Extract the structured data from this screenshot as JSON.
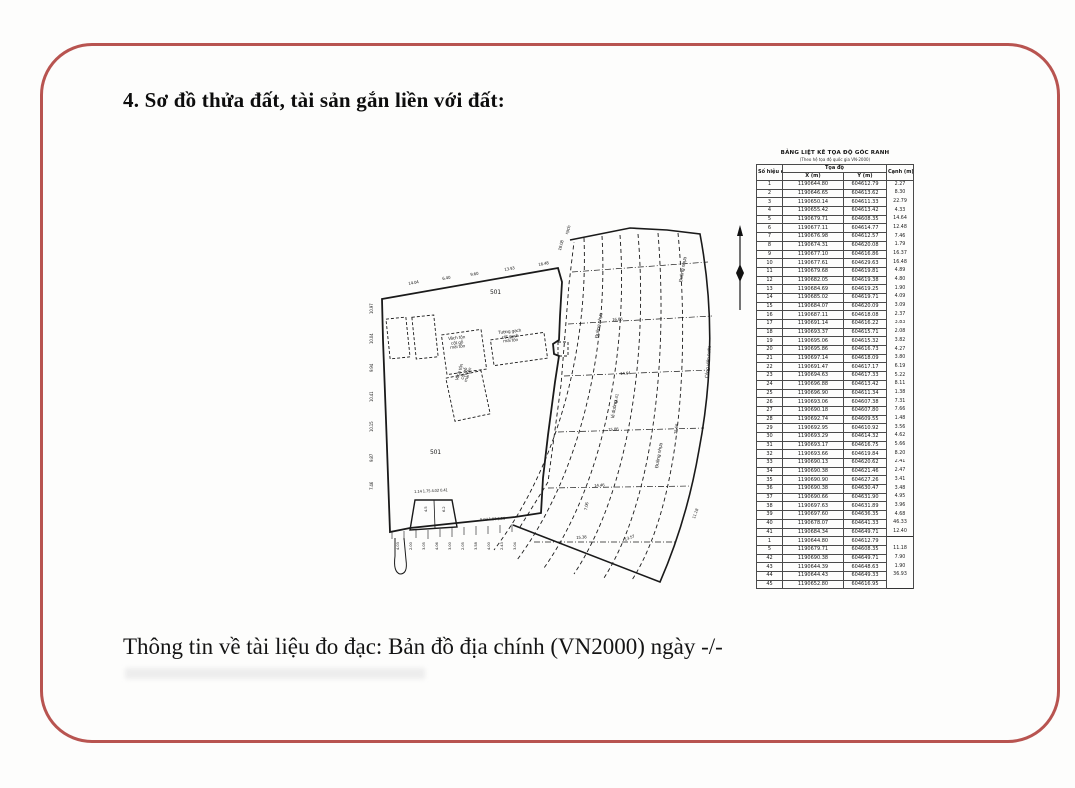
{
  "page": {
    "title": "4. Sơ đồ thửa đất, tài sản gắn liền với đất:",
    "footer_text": "Thông tin về tài liệu đo đạc: Bản đồ địa chính (VN2000) ngày -/-",
    "border_color": "#b85450"
  },
  "map": {
    "labels": [
      {
        "t": "501",
        "x": 128,
        "y": 70,
        "r": 0,
        "fs": 6
      },
      {
        "t": "501",
        "x": 68,
        "y": 230,
        "r": 0,
        "fs": 6
      },
      {
        "t": "Vách tôn\ncột gỗ\nmái tôn",
        "x": 86,
        "y": 118,
        "r": -6,
        "fs": 4.3,
        "c": 1
      },
      {
        "t": "Tường gạch\ncột gạch\nmái tôn",
        "x": 136,
        "y": 112,
        "r": -6,
        "fs": 4.3,
        "c": 1
      },
      {
        "t": "Vách tôn\ncột gỗ\nmái tôn",
        "x": 94,
        "y": 160,
        "r": -72,
        "fs": 4.3,
        "c": 1
      },
      {
        "t": "rạch",
        "x": 204,
        "y": 14,
        "r": -72,
        "fs": 4.5
      },
      {
        "t": "Đường nhựa",
        "x": 234,
        "y": 118,
        "r": -80,
        "fs": 4.5
      },
      {
        "t": "lề đường",
        "x": 250,
        "y": 198,
        "r": -80,
        "fs": 4.5
      },
      {
        "t": "Đường nhựa",
        "x": 294,
        "y": 248,
        "r": -80,
        "fs": 4.5
      },
      {
        "t": "Đường nhựa",
        "x": 318,
        "y": 62,
        "r": -80,
        "fs": 4.5
      },
      {
        "t": "Công viên nước",
        "x": 344,
        "y": 158,
        "r": -85,
        "fs": 4.5
      },
      {
        "t": "14.04",
        "x": 46,
        "y": 62,
        "r": -10,
        "fs": 4
      },
      {
        "t": "6.40",
        "x": 80,
        "y": 57,
        "r": -10,
        "fs": 4
      },
      {
        "t": "9.60",
        "x": 108,
        "y": 53,
        "r": -10,
        "fs": 4
      },
      {
        "t": "13.93",
        "x": 142,
        "y": 48,
        "r": -10,
        "fs": 4
      },
      {
        "t": "16.48",
        "x": 176,
        "y": 43,
        "r": -10,
        "fs": 4
      },
      {
        "t": "18.08",
        "x": 196,
        "y": 30,
        "r": -75,
        "fs": 4
      },
      {
        "t": "10.97",
        "x": 8,
        "y": 94,
        "r": -90,
        "fs": 4
      },
      {
        "t": "10.04",
        "x": 8,
        "y": 124,
        "r": -90,
        "fs": 4
      },
      {
        "t": "9.94",
        "x": 8,
        "y": 152,
        "r": -90,
        "fs": 4
      },
      {
        "t": "10.41",
        "x": 8,
        "y": 182,
        "r": -90,
        "fs": 4
      },
      {
        "t": "10.15",
        "x": 8,
        "y": 212,
        "r": -90,
        "fs": 4
      },
      {
        "t": "9.87",
        "x": 8,
        "y": 242,
        "r": -90,
        "fs": 4
      },
      {
        "t": "7.46",
        "x": 8,
        "y": 270,
        "r": -90,
        "fs": 4
      },
      {
        "t": "44.41",
        "x": 252,
        "y": 184,
        "r": -82,
        "fs": 4
      },
      {
        "t": "75.66",
        "x": 312,
        "y": 214,
        "r": -84,
        "fs": 4
      },
      {
        "t": "7.06",
        "x": 222,
        "y": 290,
        "r": -80,
        "fs": 4
      },
      {
        "t": "13.57",
        "x": 262,
        "y": 318,
        "r": -20,
        "fs": 4
      },
      {
        "t": "11.18",
        "x": 330,
        "y": 298,
        "r": -70,
        "fs": 4
      },
      {
        "t": "16.86",
        "x": 250,
        "y": 98,
        "r": -4,
        "fs": 4
      },
      {
        "t": "14.64",
        "x": 258,
        "y": 152,
        "r": -4,
        "fs": 4
      },
      {
        "t": "15.86",
        "x": 246,
        "y": 208,
        "r": -4,
        "fs": 4
      },
      {
        "t": "14.46",
        "x": 232,
        "y": 264,
        "r": -4,
        "fs": 4
      },
      {
        "t": "15.38",
        "x": 214,
        "y": 316,
        "r": -4,
        "fs": 4
      },
      {
        "t": "1.14 1.75 4.02 0.41",
        "x": 52,
        "y": 270,
        "r": -3,
        "fs": 3.8
      },
      {
        "t": "5.07 1.97 5.96",
        "x": 118,
        "y": 298,
        "r": -3,
        "fs": 3.8
      },
      {
        "t": "4.5",
        "x": 62,
        "y": 292,
        "r": -90,
        "fs": 3.8
      },
      {
        "t": "6.2",
        "x": 80,
        "y": 292,
        "r": -90,
        "fs": 3.8
      },
      {
        "t": "4.03",
        "x": 34,
        "y": 330,
        "r": -90,
        "fs": 3.8
      },
      {
        "t": "2.00",
        "x": 47,
        "y": 330,
        "r": -90,
        "fs": 3.8
      },
      {
        "t": "3.05",
        "x": 60,
        "y": 330,
        "r": -90,
        "fs": 3.8
      },
      {
        "t": "4.06",
        "x": 73,
        "y": 330,
        "r": -90,
        "fs": 3.8
      },
      {
        "t": "3.00",
        "x": 86,
        "y": 330,
        "r": -90,
        "fs": 3.8
      },
      {
        "t": "2.05",
        "x": 99,
        "y": 330,
        "r": -90,
        "fs": 3.8
      },
      {
        "t": "3.58",
        "x": 112,
        "y": 330,
        "r": -90,
        "fs": 3.8
      },
      {
        "t": "4.00",
        "x": 125,
        "y": 330,
        "r": -90,
        "fs": 3.8
      },
      {
        "t": "2.43",
        "x": 138,
        "y": 330,
        "r": -90,
        "fs": 3.8
      },
      {
        "t": "3.04",
        "x": 151,
        "y": 330,
        "r": -90,
        "fs": 3.8
      }
    ]
  },
  "table": {
    "title": "BẢNG LIỆT KÊ TỌA ĐỘ GÓC RANH",
    "subtitle": "(Theo hệ tọa độ quốc gia VN-2000)",
    "col_point": "Số hiệu\nđiểm",
    "col_coords": "Tọa độ",
    "col_x": "X (m)",
    "col_y": "Y (m)",
    "col_edge": "Cạnh\n(m)",
    "rows": [
      {
        "n": "1",
        "x": "1190644.80",
        "y": "604612.79",
        "d": "2.27"
      },
      {
        "n": "2",
        "x": "1190646.65",
        "y": "604613.62",
        "d": "8.30"
      },
      {
        "n": "3",
        "x": "1190650.14",
        "y": "604611.33",
        "d": "22.79"
      },
      {
        "n": "4",
        "x": "1190655.42",
        "y": "604613.42",
        "d": "4.33"
      },
      {
        "n": "5",
        "x": "1190679.71",
        "y": "604608.35",
        "d": "14.64"
      },
      {
        "n": "6",
        "x": "1190677.11",
        "y": "604614.77",
        "d": "12.48"
      },
      {
        "n": "7",
        "x": "1190676.98",
        "y": "604612.57",
        "d": "7.46"
      },
      {
        "n": "8",
        "x": "1190674.31",
        "y": "604620.08",
        "d": "1.79"
      },
      {
        "n": "9",
        "x": "1190677.10",
        "y": "604616.86",
        "d": "16.37"
      },
      {
        "n": "10",
        "x": "1190677.61",
        "y": "604629.63",
        "d": "16.48"
      },
      {
        "n": "11",
        "x": "1190679.68",
        "y": "604619.81",
        "d": "4.89"
      },
      {
        "n": "12",
        "x": "1190682.05",
        "y": "604619.38",
        "d": "4.80"
      },
      {
        "n": "13",
        "x": "1190684.69",
        "y": "604619.25",
        "d": "1.90"
      },
      {
        "n": "14",
        "x": "1190685.02",
        "y": "604619.71",
        "d": "4.09"
      },
      {
        "n": "15",
        "x": "1190684.07",
        "y": "604620.09",
        "d": "3.09"
      },
      {
        "n": "16",
        "x": "1190687.11",
        "y": "604618.08",
        "d": "2.37"
      },
      {
        "n": "17",
        "x": "1190691.14",
        "y": "604616.22",
        "d": "3.83"
      },
      {
        "n": "18",
        "x": "1190693.37",
        "y": "604615.71",
        "d": "2.08"
      },
      {
        "n": "19",
        "x": "1190695.06",
        "y": "604615.32",
        "d": "3.82"
      },
      {
        "n": "20",
        "x": "1190695.86",
        "y": "604616.73",
        "d": "4.27"
      },
      {
        "n": "21",
        "x": "1190697.14",
        "y": "604618.09",
        "d": "3.80"
      },
      {
        "n": "22",
        "x": "1190691.47",
        "y": "604617.17",
        "d": "6.19"
      },
      {
        "n": "23",
        "x": "1190694.63",
        "y": "604617.33",
        "d": "5.22"
      },
      {
        "n": "24",
        "x": "1190696.88",
        "y": "604613.42",
        "d": "8.11"
      },
      {
        "n": "25",
        "x": "1190696.90",
        "y": "604611.34",
        "d": "1.38"
      },
      {
        "n": "26",
        "x": "1190693.06",
        "y": "604607.38",
        "d": "7.31"
      },
      {
        "n": "27",
        "x": "1190690.18",
        "y": "604607.80",
        "d": "7.66"
      },
      {
        "n": "28",
        "x": "1190692.74",
        "y": "604609.55",
        "d": "1.48"
      },
      {
        "n": "29",
        "x": "1190692.95",
        "y": "604610.92",
        "d": "3.56"
      },
      {
        "n": "30",
        "x": "1190693.29",
        "y": "604614.32",
        "d": "4.62"
      },
      {
        "n": "31",
        "x": "1190693.17",
        "y": "604616.75",
        "d": "5.66"
      },
      {
        "n": "32",
        "x": "1190693.66",
        "y": "604619.84",
        "d": "8.20"
      },
      {
        "n": "33",
        "x": "1190690.13",
        "y": "604620.62",
        "d": "2.41"
      },
      {
        "n": "34",
        "x": "1190690.38",
        "y": "604621.46",
        "d": "2.47"
      },
      {
        "n": "35",
        "x": "1190690.90",
        "y": "604627.26",
        "d": "3.41"
      },
      {
        "n": "36",
        "x": "1190690.38",
        "y": "604630.47",
        "d": "3.48"
      },
      {
        "n": "37",
        "x": "1190690.66",
        "y": "604631.90",
        "d": "4.95"
      },
      {
        "n": "38",
        "x": "1190697.63",
        "y": "604631.89",
        "d": "3.96"
      },
      {
        "n": "39",
        "x": "1190697.60",
        "y": "604636.35",
        "d": "4.68"
      },
      {
        "n": "40",
        "x": "1190678.07",
        "y": "604641.33",
        "d": "46.33"
      },
      {
        "n": "41",
        "x": "1190684.34",
        "y": "604649.71",
        "d": "12.40"
      },
      {
        "n": "1",
        "x": "1190644.80",
        "y": "604612.79",
        "d": "",
        "sep": true
      },
      {
        "n": "5",
        "x": "1190679.71",
        "y": "604608.35",
        "d": "11.18"
      },
      {
        "n": "42",
        "x": "1190690.38",
        "y": "604649.71",
        "d": "7.90"
      },
      {
        "n": "43",
        "x": "1190644.39",
        "y": "604648.63",
        "d": "1.90"
      },
      {
        "n": "44",
        "x": "1190644.43",
        "y": "604649.33",
        "d": "36.93"
      },
      {
        "n": "45",
        "x": "1190652.80",
        "y": "604616.95",
        "d": ""
      }
    ]
  }
}
